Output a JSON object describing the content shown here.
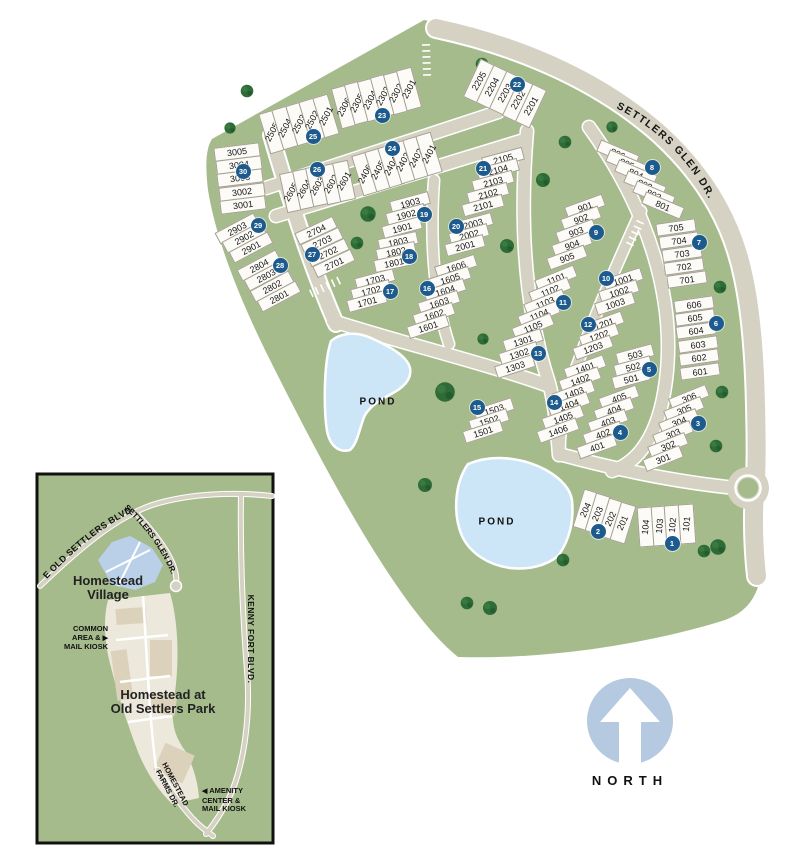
{
  "main_map": {
    "street_label": "SETTLERS GLEN DR.",
    "ponds": [
      "POND",
      "POND"
    ],
    "lot_groups": [
      {
        "marker": "1",
        "lots": [
          "104",
          "103",
          "102",
          "101"
        ]
      },
      {
        "marker": "2",
        "lots": [
          "204",
          "203",
          "202",
          "201"
        ]
      },
      {
        "marker": "3",
        "lots": [
          "306",
          "305",
          "304",
          "303",
          "302",
          "301"
        ]
      },
      {
        "marker": "4",
        "lots": [
          "405",
          "404",
          "403",
          "402",
          "401"
        ]
      },
      {
        "marker": "5",
        "lots": [
          "503",
          "502",
          "501"
        ]
      },
      {
        "marker": "6",
        "lots": [
          "606",
          "605",
          "604",
          "603",
          "602",
          "601"
        ]
      },
      {
        "marker": "7",
        "lots": [
          "705",
          "704",
          "703",
          "702",
          "701"
        ]
      },
      {
        "marker": "8",
        "lots": [
          "806",
          "805",
          "804",
          "803",
          "802",
          "801"
        ]
      },
      {
        "marker": "9",
        "lots": [
          "901",
          "902",
          "903",
          "904",
          "905"
        ]
      },
      {
        "marker": "10",
        "lots": [
          "1001",
          "1002",
          "1003"
        ]
      },
      {
        "marker": "11",
        "lots": [
          "1101",
          "1102",
          "1103",
          "1104",
          "1105"
        ]
      },
      {
        "marker": "12",
        "lots": [
          "1201",
          "1202",
          "1203"
        ]
      },
      {
        "marker": "13",
        "lots": [
          "1301",
          "1302",
          "1303"
        ]
      },
      {
        "marker": "14",
        "lots": [
          "1401",
          "1402",
          "1403",
          "1404",
          "1405",
          "1406"
        ]
      },
      {
        "marker": "15",
        "lots": [
          "1503",
          "1502",
          "1501"
        ]
      },
      {
        "marker": "16",
        "lots": [
          "1606",
          "1605",
          "1604",
          "1603",
          "1602",
          "1601"
        ]
      },
      {
        "marker": "17",
        "lots": [
          "1703",
          "1702",
          "1701"
        ]
      },
      {
        "marker": "18",
        "lots": [
          "1803",
          "1802",
          "1801"
        ]
      },
      {
        "marker": "19",
        "lots": [
          "1903",
          "1902",
          "1901"
        ]
      },
      {
        "marker": "20",
        "lots": [
          "2003",
          "2002",
          "2001"
        ]
      },
      {
        "marker": "21",
        "lots": [
          "2105",
          "2104",
          "2103",
          "2102",
          "2101"
        ]
      },
      {
        "marker": "22",
        "lots": [
          "2205",
          "2204",
          "2203",
          "2202",
          "2201"
        ]
      },
      {
        "marker": "23",
        "lots": [
          "2306",
          "2305",
          "2304",
          "2303",
          "2302",
          "2301"
        ]
      },
      {
        "marker": "24",
        "lots": [
          "2406",
          "2405",
          "2404",
          "2403",
          "2402",
          "2401"
        ]
      },
      {
        "marker": "25",
        "lots": [
          "2505",
          "2504",
          "2503",
          "2502",
          "2501"
        ]
      },
      {
        "marker": "26",
        "lots": [
          "2605",
          "2604",
          "2603",
          "2602",
          "2601"
        ]
      },
      {
        "marker": "27",
        "lots": [
          "2704",
          "2703",
          "2702",
          "2701"
        ]
      },
      {
        "marker": "28",
        "lots": [
          "2804",
          "2803",
          "2802",
          "2801"
        ]
      },
      {
        "marker": "29",
        "lots": [
          "2903",
          "2902",
          "2901"
        ]
      },
      {
        "marker": "30",
        "lots": [
          "3005",
          "3004",
          "3003",
          "3002",
          "3001"
        ]
      }
    ],
    "colors": {
      "map_green": "#a5bb8c",
      "road_tan": "#d5d2c3",
      "pond_blue": "#cde6f7",
      "marker_blue": "#1d5b8f",
      "tree_green": "#2e6c37"
    }
  },
  "inset_map": {
    "area_labels": {
      "village_line1": "Homestead",
      "village_line2": "Village",
      "park_line1": "Homestead at",
      "park_line2": "Old Settlers Park"
    },
    "streets": {
      "old_settlers": "E OLD SETTLERS BLVD.",
      "settlers_glen": "SETTLERS GLEN DR.",
      "kenny_fort": "KENNY FORT BLVD.",
      "homestead_farms_line1": "HOMESTEAD",
      "homestead_farms_line2": "FARMS DR."
    },
    "callouts": {
      "common_area": {
        "lines": [
          "COMMON",
          "AREA &",
          "MAIL KIOSK"
        ],
        "arrow": "▶"
      },
      "amenity": {
        "lines": [
          "AMENITY",
          "CENTER &",
          "MAIL KIOSK"
        ],
        "arrow": "◀"
      }
    }
  },
  "compass": {
    "label": "NORTH"
  }
}
